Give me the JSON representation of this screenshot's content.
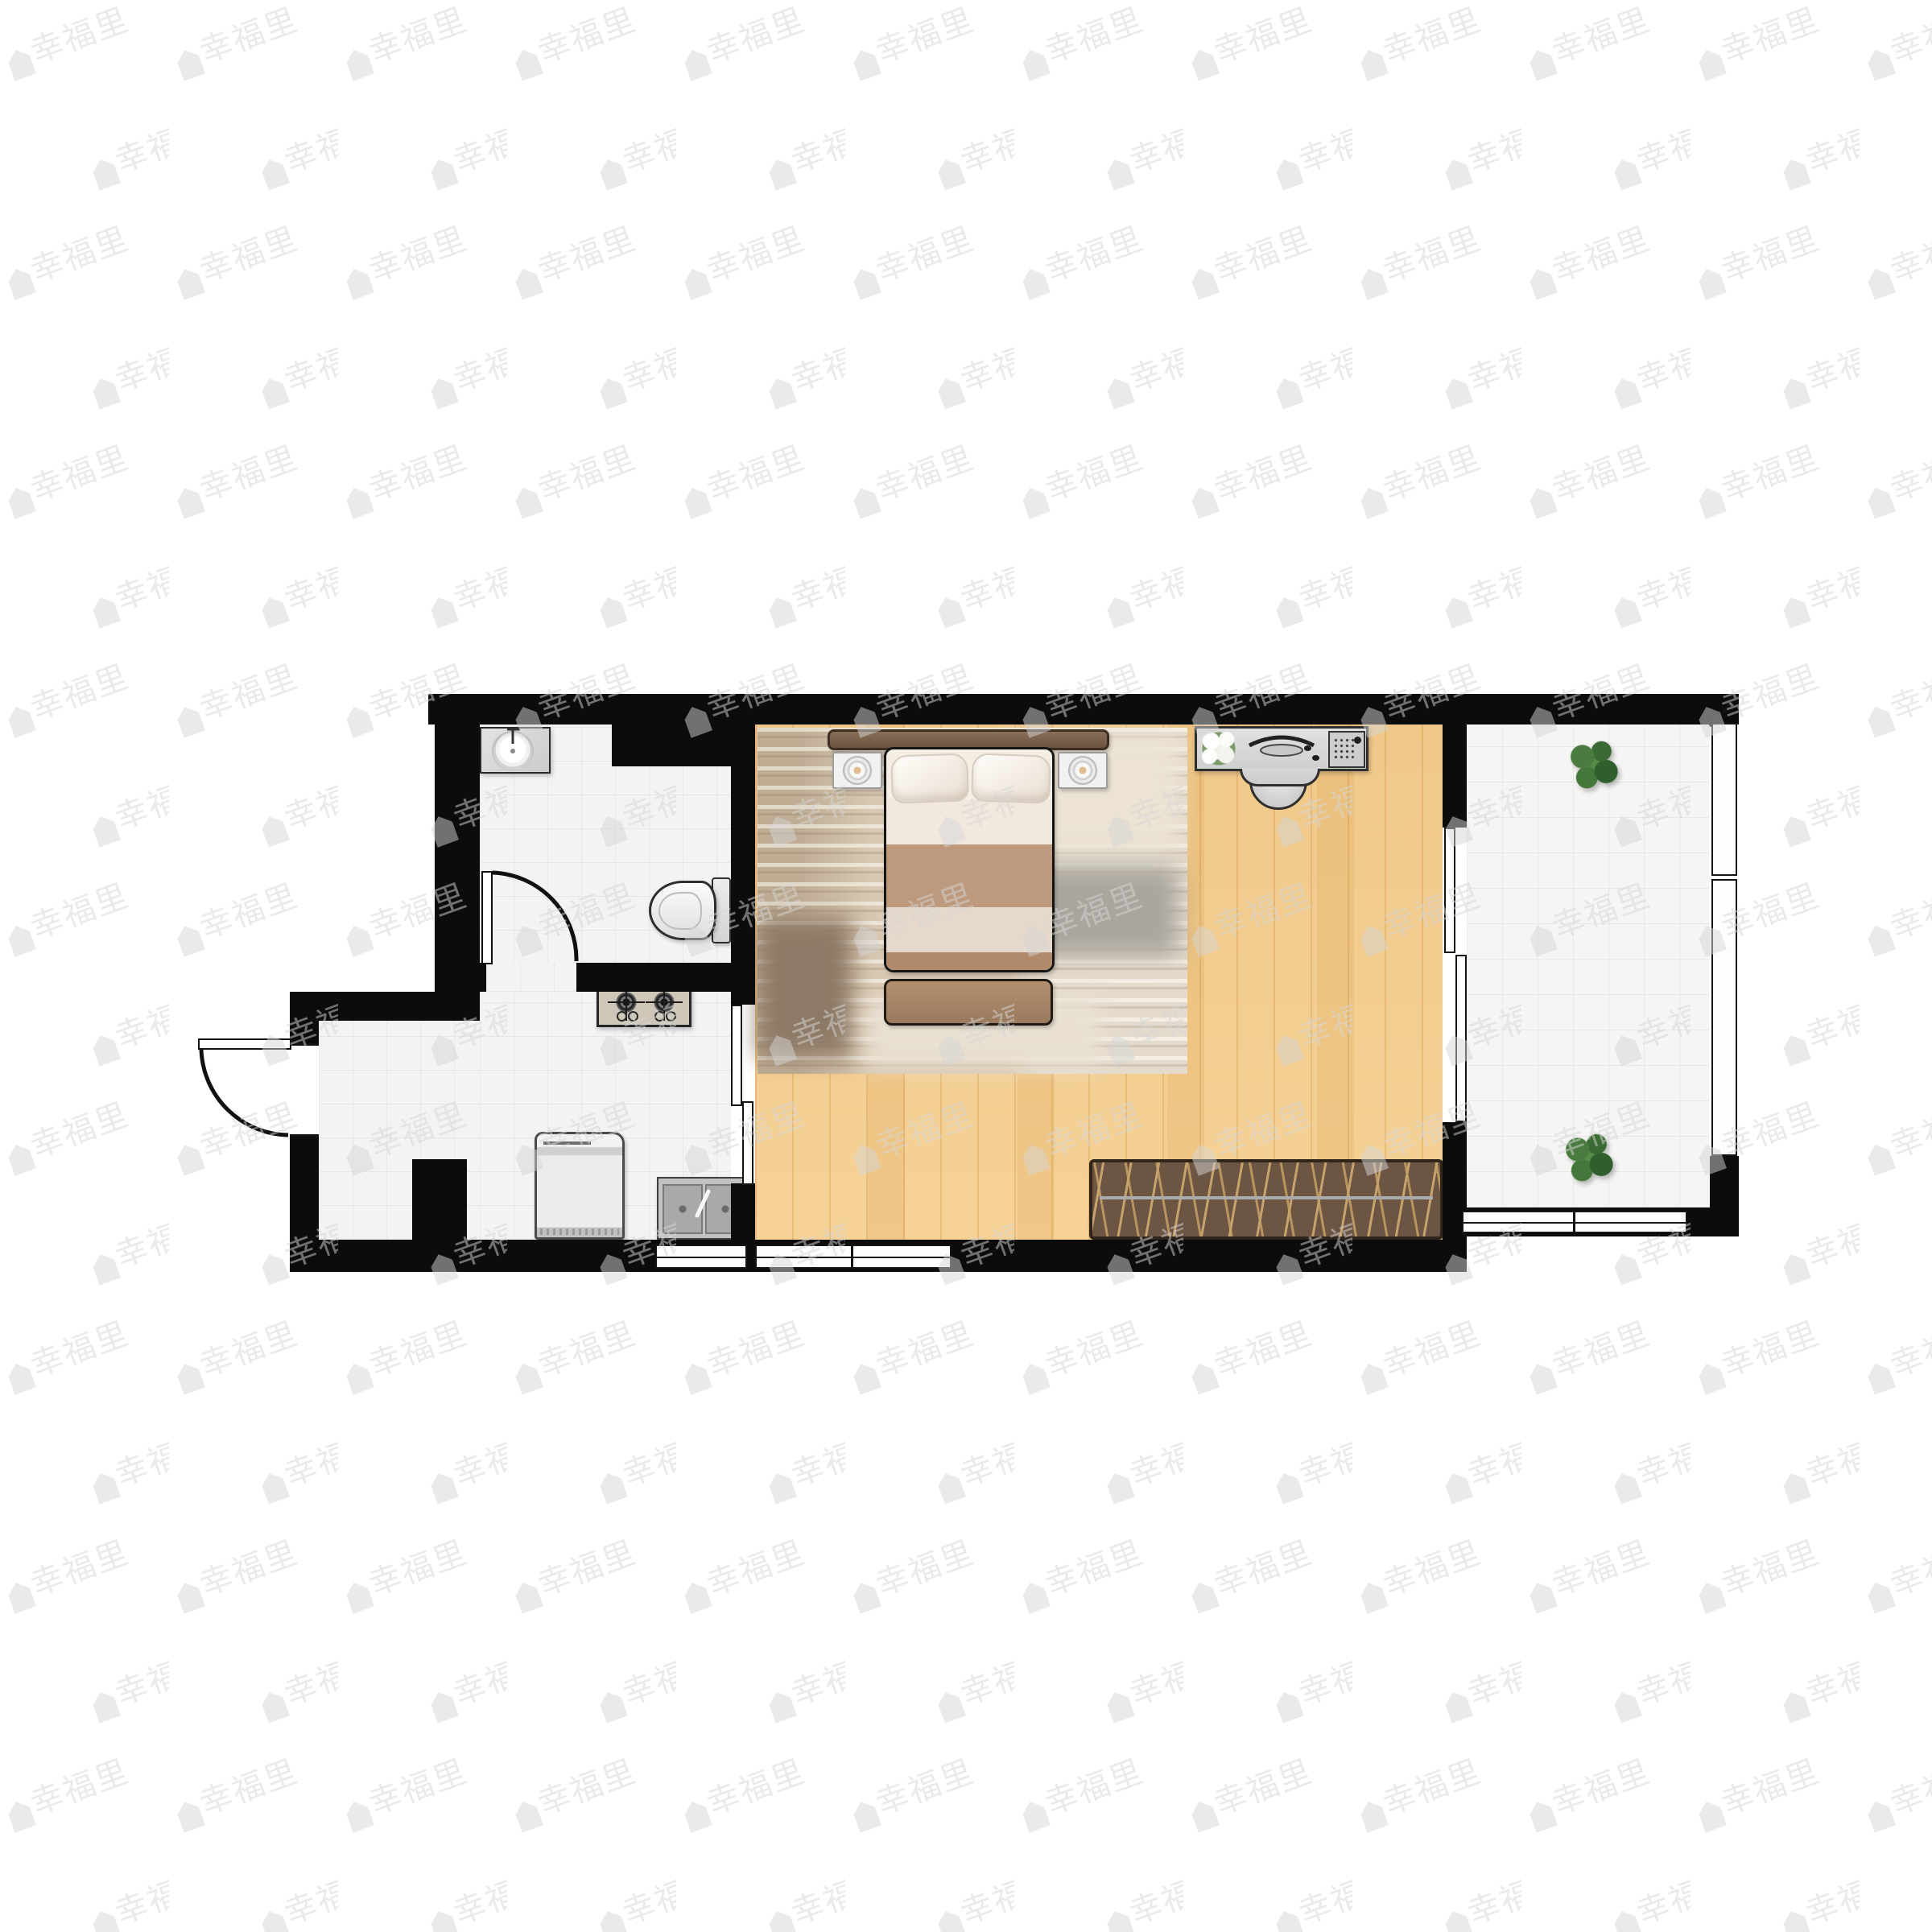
{
  "watermark": {
    "text": "幸福里",
    "icon": "house-icon"
  },
  "palette": {
    "wall": "#0c0c0c",
    "tile_floor": "#f3f3f3",
    "wood_floor": "#f5cf90",
    "rug": "#d8c8b2",
    "bed_blanket_tan": "#bd9a7e",
    "bed_blanket_brown": "#b18a6c",
    "headboard_brown": "#6b523f",
    "bench_brown": "#6d5544",
    "bench_stick_tan": "#c6a26c",
    "plant_green": "#3a6b33",
    "appliance_gray": "#d8d8d8",
    "stove_beige": "#cec6b6",
    "background": "#ffffff"
  },
  "rooms": [
    {
      "name": "bathroom"
    },
    {
      "name": "kitchen-entry-hall"
    },
    {
      "name": "bedroom-living-room"
    },
    {
      "name": "balcony"
    }
  ],
  "furniture": [
    "vanity-sink",
    "toilet",
    "bathroom-door",
    "entry-door",
    "gas-stove",
    "washing-machine",
    "kitchen-double-sink",
    "double-bed",
    "pillows",
    "nightstand-left",
    "nightstand-right",
    "bedside-lamps",
    "bed-ottoman",
    "area-rug",
    "computer-desk",
    "desk-chair",
    "desk-flowers",
    "desk-computer",
    "slatted-bench",
    "kitchen-sliding-door",
    "balcony-sliding-door",
    "balcony-plant-top",
    "balcony-plant-bottom"
  ],
  "windows": [
    "kitchen-south-window",
    "bedroom-south-window",
    "balcony-south-window",
    "balcony-east-window-upper",
    "balcony-east-window-lower"
  ]
}
